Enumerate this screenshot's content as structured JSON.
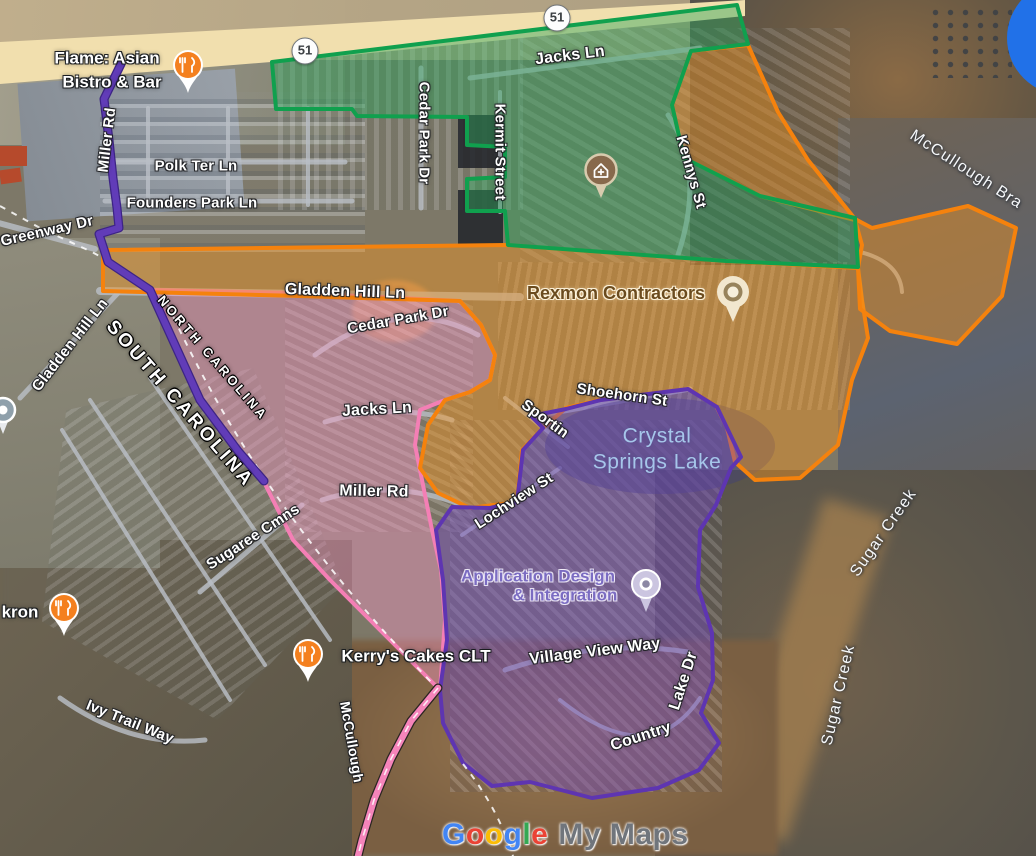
{
  "app": "Google My Maps",
  "colors": {
    "green_stroke": "#10A04E",
    "green_fill": "rgba(44,166,92,0.44)",
    "orange_stroke": "#F5820D",
    "orange_fill": "rgba(244,148,30,0.44)",
    "pink_stroke": "#F47FB5",
    "pink_fill": "rgba(246,152,198,0.42)",
    "purple_stroke": "#5E35B1",
    "purple_fill": "rgba(114,70,192,0.44)",
    "road": "#b9bec6",
    "highway": "#f1dfae",
    "blue_marker": "#2171E8",
    "restaurant_pin": "#F4801F"
  },
  "shapes": {
    "highway": {
      "points": "0,42 300,26 745,0 745,16 320,58 0,84",
      "fill": "#f1dfae"
    },
    "lake": {
      "cx": 660,
      "cy": 446,
      "rx": 115,
      "ry": 48
    },
    "blue_disc": {
      "cx": 1064,
      "cy": 38,
      "r": 57,
      "fill": "#2171E8"
    },
    "roads": [
      {
        "d": "M108,162 H345",
        "w": 5
      },
      {
        "d": "M105,201 H352",
        "w": 5
      },
      {
        "d": "M148,108 V205",
        "w": 4
      },
      {
        "d": "M228,108 V205",
        "w": 4
      },
      {
        "d": "M308,108 V205",
        "w": 4
      },
      {
        "d": "M100,291 L520,297",
        "w": 8
      },
      {
        "d": "M-5,222 L95,249",
        "w": 6
      },
      {
        "d": "M20,398 L118,293",
        "w": 5
      },
      {
        "d": "M470,78 L700,48",
        "w": 5
      },
      {
        "d": "M421,68 V208",
        "w": 5
      },
      {
        "d": "M500,92 V212",
        "w": 4
      },
      {
        "d": "M668,115 Q706,170 678,255",
        "w": 5
      },
      {
        "d": "M315,355 Q400,293 478,335",
        "w": 5
      },
      {
        "d": "M325,422 Q392,402 452,420",
        "w": 5
      },
      {
        "d": "M322,500 Q392,478 462,505",
        "w": 5
      },
      {
        "d": "M535,416 L690,389",
        "w": 5
      },
      {
        "d": "M505,398 L568,447",
        "w": 4
      },
      {
        "d": "M462,535 L560,468",
        "w": 4
      },
      {
        "d": "M505,670 Q600,638 688,652",
        "w": 5
      },
      {
        "d": "M560,700 Q650,772 700,698",
        "w": 4
      },
      {
        "d": "M200,592 L302,505",
        "w": 5
      },
      {
        "d": "M60,698 Q130,748 205,740",
        "w": 5
      },
      {
        "d": "M90,400 L265,665",
        "w": 4
      },
      {
        "d": "M150,378 L330,640",
        "w": 4
      },
      {
        "d": "M62,430 L230,700",
        "w": 4
      },
      {
        "d": "M860,252 Q900,262 902,292",
        "w": 4
      }
    ],
    "polygons": [
      {
        "name": "pink-territory",
        "stroke": "#F47FB5",
        "fill": "rgba(246,152,198,0.42)",
        "w": 4,
        "points": "150,290 300,293 460,301 481,325 495,355 490,380 470,392 445,400 420,410 415,445 423,485 432,530 441,570 445,620 440,690 370,620 330,580 293,540 263,480 237,450 200,400 157,297"
      },
      {
        "name": "orange-territory-main",
        "stroke": "#F5820D",
        "fill": "rgba(244,148,30,0.44)",
        "w": 4,
        "points": "103,250 506,245 726,261 858,268 862,300 868,338 852,380 838,445 800,478 755,480 735,462 727,428 716,406 688,389 600,400 566,408 543,428 522,450 517,502 470,508 438,493 420,468 428,425 445,400 470,392 490,380 495,355 481,325 460,301 300,296 103,291"
      },
      {
        "name": "orange-territory-north",
        "stroke": "#F5820D",
        "fill": "rgba(244,148,30,0.44)",
        "w": 4,
        "points": "691,51 748,45 778,112 808,160 855,219 872,228 968,206 1016,228 1002,296 957,344 890,331 860,309 858,268 862,245 855,220 760,196 684,158 672,105"
      },
      {
        "name": "green-territory",
        "stroke": "#10A04E",
        "fill": "rgba(44,166,92,0.44)",
        "w": 4,
        "points": "272,62 737,5 748,44 691,51 672,105 684,158 760,196 855,218 858,267 726,261 508,245 505,211 467,211 467,179 505,177 505,147 467,145 467,117 357,116 352,109 276,109"
      },
      {
        "name": "purple-territory",
        "stroke": "#5E35B1",
        "fill": "rgba(114,70,192,0.44)",
        "w": 4,
        "points": "531,416 566,409 601,400 688,389 717,407 741,457 731,468 716,505 700,530 698,587 712,633 713,680 701,713 719,743 699,770 658,788 592,798 530,782 492,786 463,763 443,723 440,690 447,640 443,580 436,530 452,507 490,508 517,502 523,450 543,428"
      }
    ],
    "routes": [
      {
        "name": "purple-route-miller-rd",
        "stroke": "#613CB8",
        "casing": "#3d2485",
        "w": 6.5,
        "d": "M121,64 L104,99 L109,140 L113,178 L117,208 L119,228 L99,234 L108,262 L150,290 L200,400 L238,451 L264,481"
      },
      {
        "name": "pink-route-mccullough",
        "stroke": "#F584BA",
        "casing": "#2a2522",
        "w": 6.5,
        "dash": "#ffffff",
        "d": "M438,688 L411,721 L391,759 L374,800 L362,840 L358,856"
      }
    ],
    "trails": [
      "M0,206 L40,228 L92,252 L128,272",
      "M168,305 C220,420 300,548 437,688",
      "M463,764 Q498,808 513,856"
    ]
  },
  "labels": [
    {
      "id": "polk-ter-ln",
      "text": "Polk Ter Ln",
      "x": 196,
      "y": 166,
      "rot": 0,
      "size": 15,
      "cls": "road"
    },
    {
      "id": "founders-park-ln",
      "text": "Founders Park Ln",
      "x": 192,
      "y": 203,
      "rot": 0,
      "size": 15,
      "cls": "road"
    },
    {
      "id": "greenway-dr",
      "text": "Greenway Dr",
      "x": 47,
      "y": 231,
      "rot": -13,
      "size": 15,
      "cls": "road"
    },
    {
      "id": "gladden-hill-ln-west",
      "text": "Gladden Hill Ln",
      "x": 70,
      "y": 345,
      "rot": -52,
      "size": 15,
      "cls": "road"
    },
    {
      "id": "gladden-hill-ln",
      "text": "Gladden Hill Ln",
      "x": 345,
      "y": 292,
      "rot": 2,
      "size": 16,
      "cls": "road"
    },
    {
      "id": "jacks-ln-north",
      "text": "Jacks Ln",
      "x": 570,
      "y": 56,
      "rot": -7,
      "size": 16,
      "cls": "road"
    },
    {
      "id": "cedar-park-dr-north",
      "text": "Cedar Park Dr",
      "x": 424,
      "y": 133,
      "rot": 90,
      "size": 15,
      "cls": "road"
    },
    {
      "id": "kermit-street",
      "text": "Kermit Street",
      "x": 500,
      "y": 152,
      "rot": 90,
      "size": 15,
      "cls": "road"
    },
    {
      "id": "kennys-st",
      "text": "Kennys St",
      "x": 691,
      "y": 172,
      "rot": 74,
      "size": 15,
      "cls": "road"
    },
    {
      "id": "cedar-park-dr-south",
      "text": "Cedar Park Dr",
      "x": 398,
      "y": 320,
      "rot": -10,
      "size": 15,
      "cls": "road"
    },
    {
      "id": "jacks-ln-south",
      "text": "Jacks Ln",
      "x": 377,
      "y": 410,
      "rot": -3,
      "size": 16,
      "cls": "road"
    },
    {
      "id": "miller-rd",
      "text": "Miller Rd",
      "x": 374,
      "y": 492,
      "rot": 1,
      "size": 16,
      "cls": "road"
    },
    {
      "id": "miller-rd-route",
      "text": "Miller Rd",
      "x": 107,
      "y": 140,
      "rot": -83,
      "size": 15,
      "cls": "road"
    },
    {
      "id": "sugaree-cmns",
      "text": "Sugaree Cmns",
      "x": 253,
      "y": 537,
      "rot": -33,
      "size": 15,
      "cls": "road"
    },
    {
      "id": "ivy-trail-way",
      "text": "Ivy Trail Way",
      "x": 130,
      "y": 722,
      "rot": 22,
      "size": 15,
      "cls": "road"
    },
    {
      "id": "shoehorn-st",
      "text": "Shoehorn St",
      "x": 622,
      "y": 395,
      "rot": 8,
      "size": 15,
      "cls": "road"
    },
    {
      "id": "sportin-st",
      "text": "Sportin",
      "x": 545,
      "y": 419,
      "rot": 36,
      "size": 15,
      "cls": "road"
    },
    {
      "id": "lochview-st",
      "text": "Lochview St",
      "x": 514,
      "y": 501,
      "rot": -33,
      "size": 15,
      "cls": "road"
    },
    {
      "id": "village-view-way",
      "text": "Village View Way",
      "x": 595,
      "y": 652,
      "rot": -7,
      "size": 16,
      "cls": "road"
    },
    {
      "id": "country-lake-dr-1",
      "text": "Country",
      "x": 641,
      "y": 737,
      "rot": -18,
      "size": 16,
      "cls": "road"
    },
    {
      "id": "country-lake-dr-2",
      "text": "Lake Dr",
      "x": 684,
      "y": 681,
      "rot": -72,
      "size": 16,
      "cls": "road"
    },
    {
      "id": "mccullough-route",
      "text": "McCullough",
      "x": 352,
      "y": 742,
      "rot": 80,
      "size": 14,
      "cls": "road"
    },
    {
      "id": "mccullough-bra",
      "text": "McCullough Bra",
      "x": 966,
      "y": 170,
      "rot": 33,
      "size": 16,
      "cls": "water"
    },
    {
      "id": "sugar-creek-upper",
      "text": "Sugar Creek",
      "x": 884,
      "y": 533,
      "rot": -55,
      "size": 16,
      "cls": "water"
    },
    {
      "id": "sugar-creek-lower",
      "text": "Sugar Creek",
      "x": 839,
      "y": 695,
      "rot": -77,
      "size": 16,
      "cls": "water"
    },
    {
      "id": "north-carolina",
      "text": "NORTH CAROLINA",
      "x": 213,
      "y": 358,
      "rot": 49,
      "size": 13,
      "cls": "area"
    },
    {
      "id": "south-carolina",
      "text": "SOUTH CAROLINA",
      "x": 180,
      "y": 404,
      "rot": 49,
      "size": 19,
      "cls": "area"
    },
    {
      "id": "crystal-springs-lake-1",
      "text": "Crystal",
      "x": 657,
      "y": 436,
      "rot": 0,
      "size": 21,
      "cls": "lake"
    },
    {
      "id": "crystal-springs-lake-2",
      "text": "Springs Lake",
      "x": 657,
      "y": 462,
      "rot": 0,
      "size": 21,
      "cls": "lake"
    },
    {
      "id": "flame-asian-1",
      "text": "Flame: Asian",
      "x": 107,
      "y": 58,
      "rot": 0,
      "size": 17,
      "cls": "poi-white"
    },
    {
      "id": "flame-asian-2",
      "text": "Bistro & Bar",
      "x": 112,
      "y": 82,
      "rot": 0,
      "size": 17,
      "cls": "poi-white"
    },
    {
      "id": "kron",
      "text": "kron",
      "x": 20,
      "y": 612,
      "rot": 0,
      "size": 17,
      "cls": "poi-white"
    },
    {
      "id": "kerrys-cakes-clt",
      "text": "Kerry's Cakes CLT",
      "x": 416,
      "y": 656,
      "rot": 0,
      "size": 17,
      "cls": "poi-white"
    },
    {
      "id": "rexmon-contractors",
      "text": "Rexmon Contractors",
      "x": 616,
      "y": 293,
      "rot": 0,
      "size": 18,
      "cls": "poi-rexmon"
    },
    {
      "id": "application-design-1",
      "text": "Application Design",
      "x": 538,
      "y": 576,
      "rot": 0,
      "size": 17,
      "cls": "poi-app"
    },
    {
      "id": "application-design-2",
      "text": "& Integration",
      "x": 565,
      "y": 595,
      "rot": 0,
      "size": 17,
      "cls": "poi-app"
    }
  ],
  "pois": [
    {
      "name": "flame-restaurant-pin",
      "type": "restaurant",
      "x": 190,
      "y": 67
    },
    {
      "name": "kron-restaurant-pin",
      "type": "restaurant",
      "x": 66,
      "y": 610
    },
    {
      "name": "kerrys-restaurant-pin",
      "type": "restaurant",
      "x": 310,
      "y": 656
    },
    {
      "name": "rexmon-pin",
      "type": "dot",
      "x": 733,
      "y": 292
    },
    {
      "name": "application-design-pin",
      "type": "dot2",
      "x": 648,
      "y": 586
    },
    {
      "name": "home-plus-pin",
      "type": "home",
      "x": 601,
      "y": 170
    },
    {
      "name": "generic-gray-pin",
      "type": "generic",
      "x": 7,
      "y": 414
    }
  ],
  "badges": [
    {
      "label": "51",
      "x": 305,
      "y": 51
    },
    {
      "label": "51",
      "x": 557,
      "y": 18
    }
  ],
  "watermark": {
    "brand": [
      [
        "G",
        "#4285F4"
      ],
      [
        "o",
        "#EA4335"
      ],
      [
        "o",
        "#FBBC05"
      ],
      [
        "g",
        "#4285F4"
      ],
      [
        "l",
        "#34A853"
      ],
      [
        "e",
        "#EA4335"
      ]
    ],
    "suffix": "My Maps",
    "x": 442,
    "y": 818
  }
}
